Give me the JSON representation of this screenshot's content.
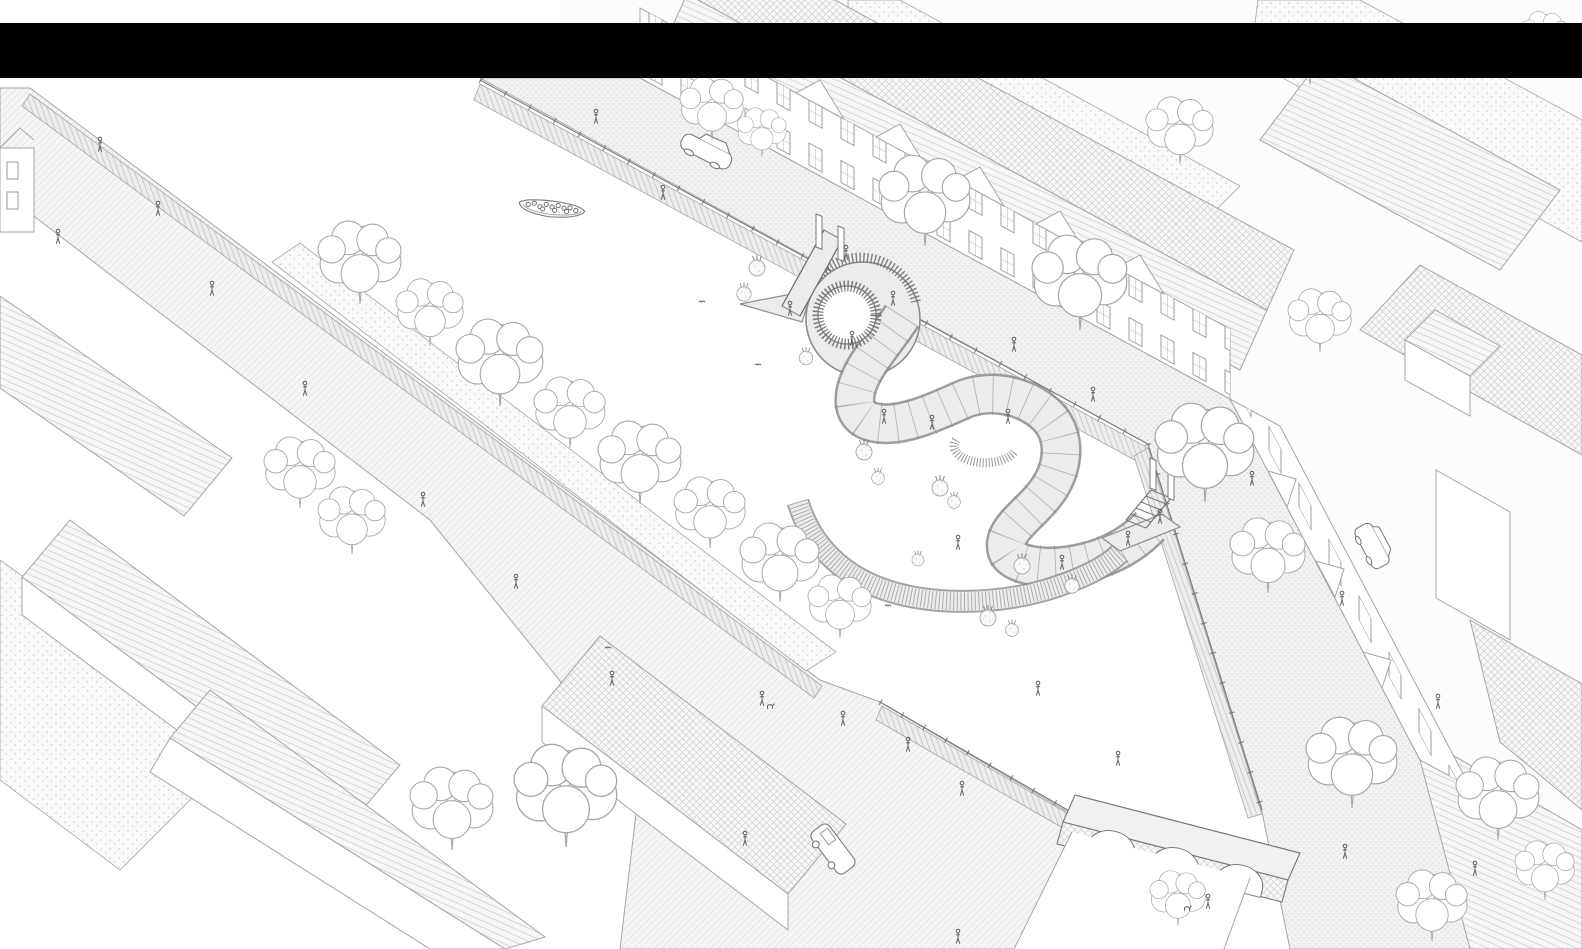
{
  "colors": {
    "background": "#ffffff",
    "redaction_bar": "#000000",
    "line": "#a6a6a6",
    "line_strong": "#7a7a7a",
    "figure": "#5f5f5f",
    "street": "#f1f1f1",
    "street_dot": "#d4d4d4",
    "path": "#f5f5f5",
    "path_line": "#e2e2e2",
    "ground": "#fafafa",
    "ground_dot": "#c8c8c8",
    "roof": "#f7f7f7",
    "roof_line": "#c9c9c9",
    "wall": "#ffffff",
    "walkway": "#ececec",
    "walkway_edge": "#8d8d8d",
    "railing": "#6e6e6e",
    "water": "#ffffff"
  },
  "scene": {
    "kind": "axonometric-line-drawing",
    "elements": [
      "redaction-bar",
      "canal-basin",
      "serpentine-walkway",
      "entry-gangway",
      "exit-stair",
      "tour-boat",
      "arched-stone-bridge",
      "canal-house-row-north",
      "canal-house-row-east",
      "northeast-rooftops",
      "southwest-blocks",
      "west-promenade",
      "south-plaza",
      "street-trees",
      "planting-beds",
      "quay-railings",
      "pedestrians",
      "dogs",
      "birds",
      "sedan-car",
      "minivan-car",
      "delivery-van"
    ]
  }
}
